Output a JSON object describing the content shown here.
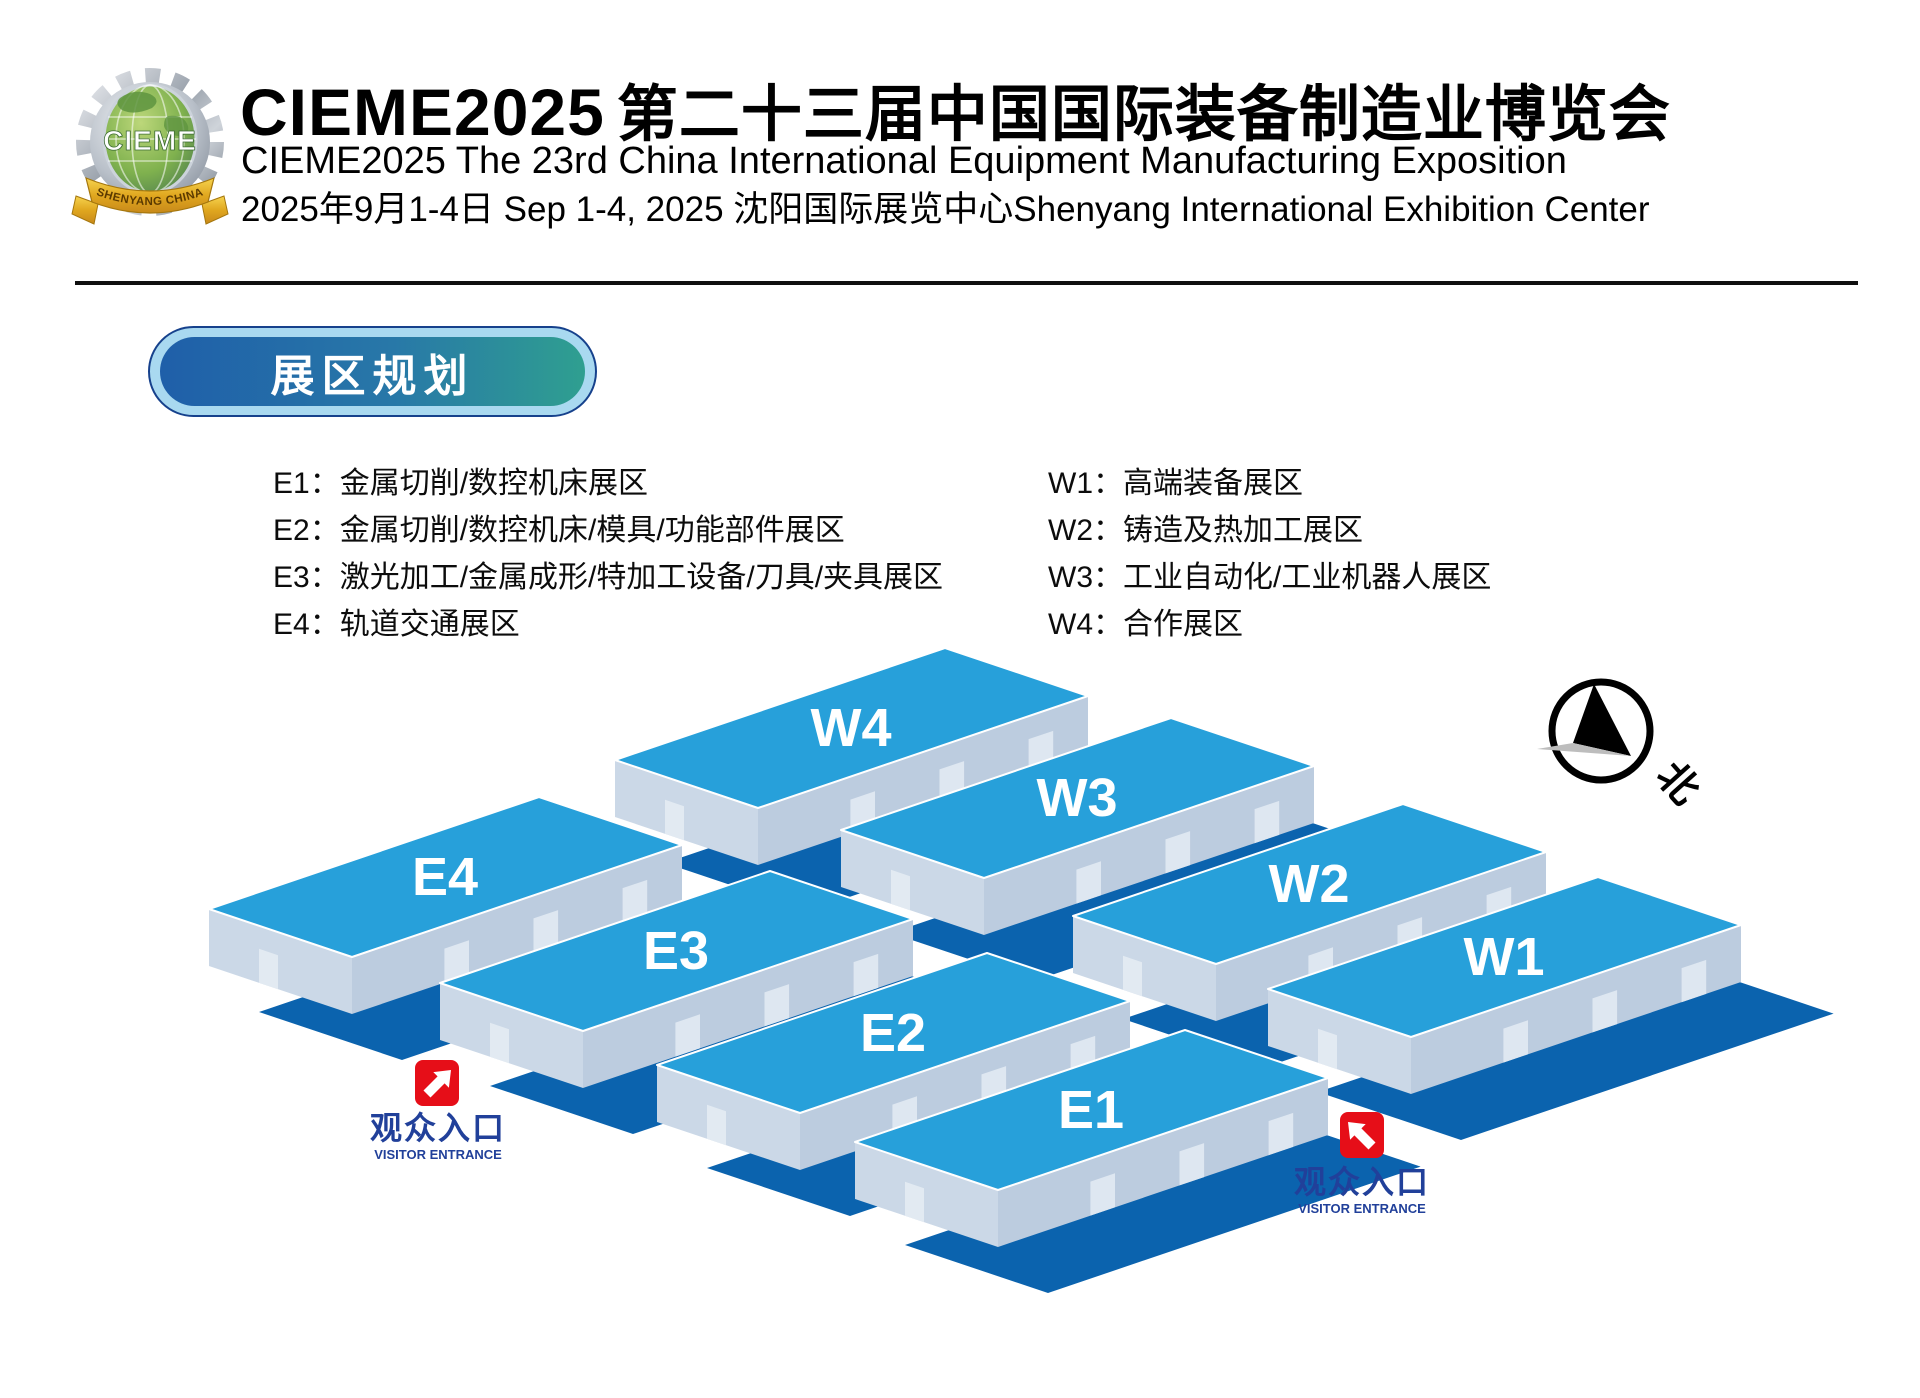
{
  "header": {
    "logo": {
      "abbr": "CIEME",
      "ribbon": "SHENYANG CHINA"
    },
    "title_latin": "CIEME2025",
    "title_cn": "第二十三届中国国际装备制造业博览会",
    "subtitle_en": "CIEME2025 The 23rd China International Equipment Manufacturing Exposition",
    "date_venue": "2025年9月1-4日 Sep 1-4, 2025 沈阳国际展览中心Shenyang International Exhibition Center"
  },
  "section": {
    "badge": "展区规划"
  },
  "legend": {
    "east": [
      "E1：金属切削/数控机床展区",
      "E2：金属切削/数控机床/模具/功能部件展区",
      "E3：激光加工/金属成形/特加工设备/刀具/夹具展区",
      "E4：轨道交通展区"
    ],
    "west": [
      "W1：高端装备展区",
      "W2：铸造及热加工展区",
      "W3：工业自动化/工业机器人展区",
      "W4：合作展区"
    ]
  },
  "map": {
    "halls": [
      {
        "label": "W4"
      },
      {
        "label": "W3"
      },
      {
        "label": "W2"
      },
      {
        "label": "W1"
      },
      {
        "label": "E4"
      },
      {
        "label": "E3"
      },
      {
        "label": "E2"
      },
      {
        "label": "E1"
      }
    ],
    "compass_north": "北",
    "entrances": [
      {
        "cn": "观众入口",
        "en": "VISITOR ENTRANCE"
      },
      {
        "cn": "观众入口",
        "en": "VISITOR ENTRANCE"
      }
    ]
  },
  "colors": {
    "roof_blue": "#27A0DA",
    "wall_end": "#CBD8E7",
    "wall_long": "#BCCCDF",
    "door": "#DEE7F1",
    "ground_shadow": "#0B63AE",
    "entrance_red": "#E60E18",
    "entrance_text_blue": "#21409A",
    "badge_halo": "#A9D9F0",
    "badge_gradient": [
      "#1F5FA9",
      "#2F9F90"
    ]
  }
}
